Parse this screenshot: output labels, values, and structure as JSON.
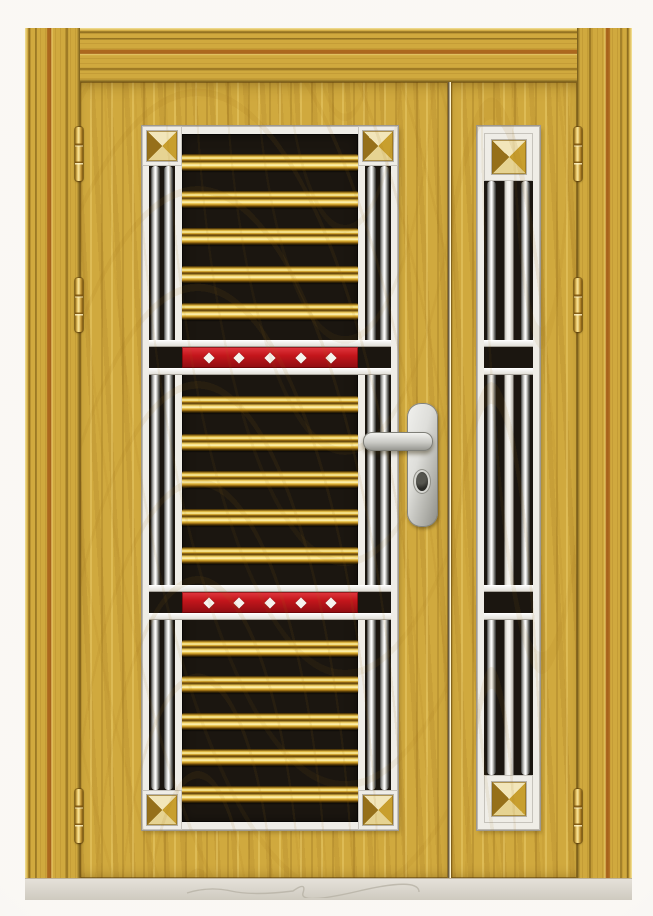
{
  "meta": {
    "kind": "product photograph",
    "subject": "luxury stainless-grille security door, golden woodgrain finish"
  },
  "scene": {
    "description": "Photograph of a golden woodgrain double door set: a wide main leaf with an ornamental grille of chrome vertical bars, gold horizontal bars, two red accent bands with white diamonds and pyramid corner studs, plus a narrow matching side panel; brass hinges on both jambs, a satin-silver lever handle with keyhole, stepped wood architrave, light grey threshold and plain white backdrop",
    "backdrop": "plain white studio backdrop",
    "threshold": "light grey floor strip with a faint handwritten mark"
  },
  "door": {
    "frame": {
      "material": "golden woodgrain architrave",
      "molding_steps": 4
    },
    "main_leaf": {
      "name": "main door leaf",
      "handle": {
        "type": "lever handle on backplate",
        "finish": "satin silver",
        "keyhole": true
      },
      "grille": {
        "corner_studs": 4,
        "stud_style": "gold pyramid",
        "chrome_bars_per_column": 2,
        "sections": [
          {
            "gold_bars": 5
          },
          {
            "gold_bars": 5
          },
          {
            "gold_bars": 5
          }
        ],
        "red_bands": [
          {
            "diamonds": 5
          },
          {
            "diamonds": 5
          }
        ]
      }
    },
    "side_panel": {
      "name": "narrow side panel leaf",
      "grille": {
        "corner_studs": 2,
        "chrome_bars": 2,
        "center_flat_bars": 1,
        "cross_rails": 2
      }
    },
    "hinges": {
      "left": 3,
      "right": 3,
      "finish": "brass"
    }
  },
  "colors": {
    "backdrop": "#f7f4ef",
    "wood": "#d0a93e",
    "wood_dark": "#8f6a1d",
    "wood_light": "#e9d06e",
    "panel_white": "#efede7",
    "grille_black": "#1b1610",
    "gold_bar": "#e7bd3f",
    "accent_red": "#c4161c",
    "diamond_white": "#f6f4ef",
    "chrome": "#d9d9d6",
    "brass_hinge": "#d8ae4e",
    "handle_silver": "#b0b0aa",
    "threshold": "#d9d5cc"
  }
}
